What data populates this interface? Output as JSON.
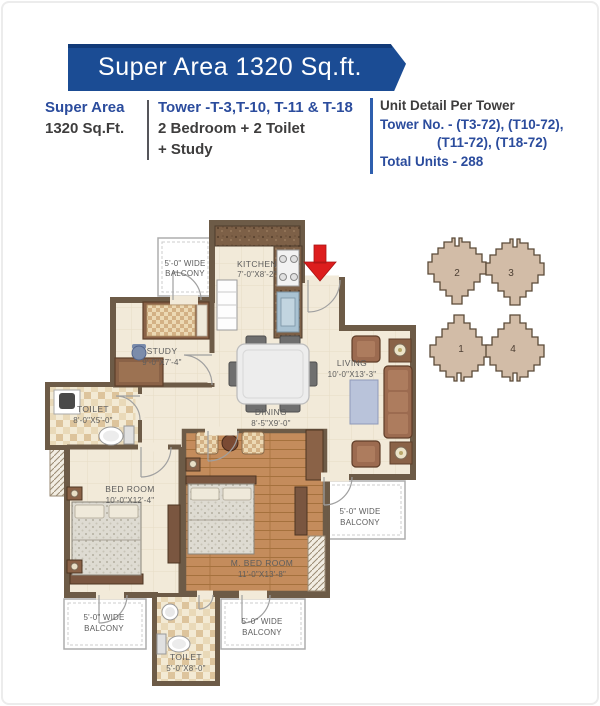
{
  "banner": {
    "title": "Super Area 1320 Sq.ft."
  },
  "info": {
    "super_area_label": "Super Area",
    "super_area_value": "1320 Sq.Ft.",
    "towers": "Tower -T-3,T-10, T-11 & T-18",
    "config_line1": "2 Bedroom + 2 Toilet",
    "config_line2": "+ Study",
    "unit_detail_heading": "Unit Detail Per Tower",
    "tower_no_line1": "Tower No. - (T3-72), (T10-72),",
    "tower_no_line2": "(T11-72), (T18-72)",
    "total_units": "Total Units - 288"
  },
  "plan": {
    "kitchen": {
      "name": "KITCHEN",
      "dims": "7'-0\"X8'-2\""
    },
    "study": {
      "name": "STUDY",
      "dims": "9'-0\"X7'-4\""
    },
    "toilet_left": {
      "name": "TOILET",
      "dims": "8'-0\"X5'-0\""
    },
    "living": {
      "name": "LIVING",
      "dims": "10'-0\"X13'-3\""
    },
    "dining": {
      "name": "DINING",
      "dims": "8'-5\"X9'-0\""
    },
    "bedroom": {
      "name": "BED ROOM",
      "dims": "10'-0\"X12'-4\""
    },
    "master_bedroom": {
      "name": "M. BED ROOM",
      "dims": "11'-0\"X13'-8\""
    },
    "toilet_bottom": {
      "name": "TOILET",
      "dims": "5'-0\"X8'-0\""
    },
    "balcony": {
      "line1": "5'-0\" WIDE",
      "line2": "BALCONY"
    }
  },
  "keyplan": {
    "unit1": "1",
    "unit2": "2",
    "unit3": "3",
    "unit4": "4"
  },
  "colors": {
    "banner_blue": "#1b4c94",
    "text_blue": "#2b4c9d",
    "arrow_red": "#dd1d1d",
    "wall": "#6d5b47",
    "floor": "#f2ead9",
    "wood": "#c48c5c",
    "keyplan_fill": "#d2bca7"
  }
}
